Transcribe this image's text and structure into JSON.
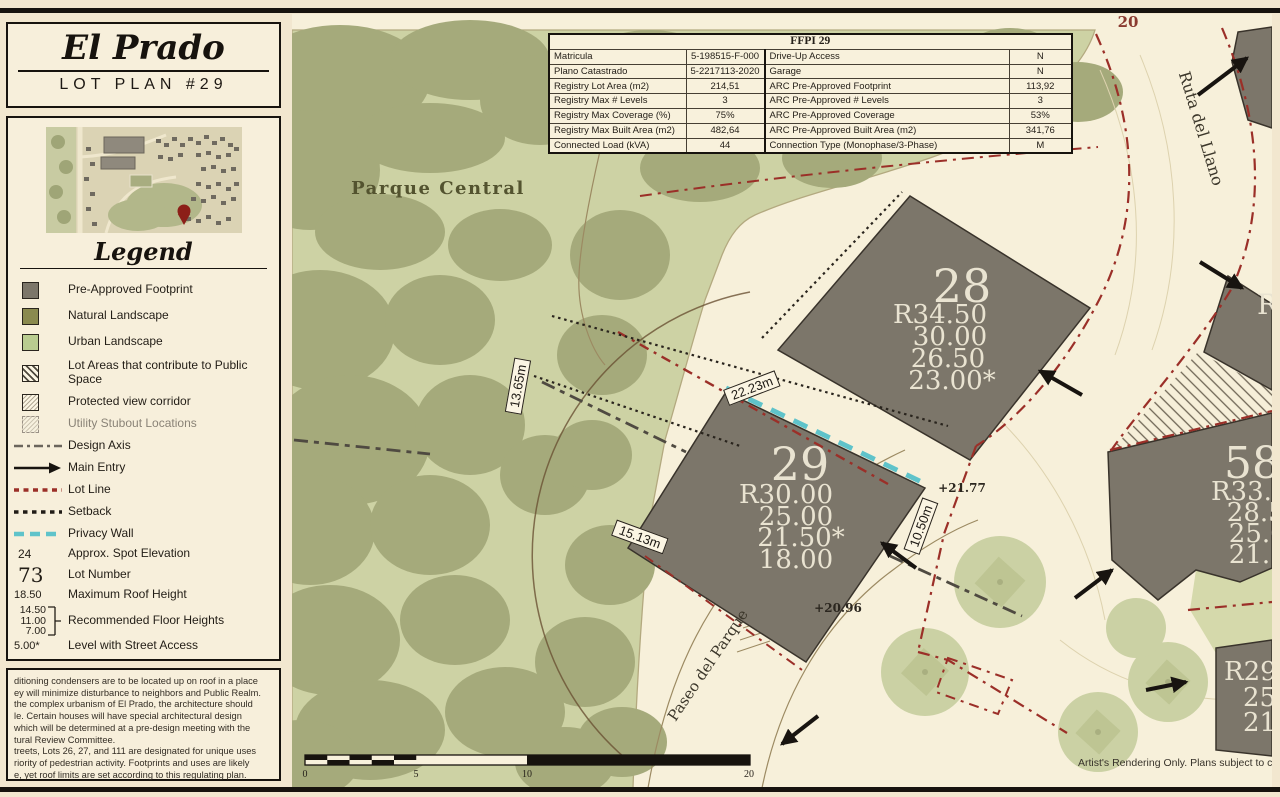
{
  "title": {
    "name": "El Prado",
    "subtitle": "LOT PLAN #29"
  },
  "legend": {
    "heading": "Legend",
    "items": [
      {
        "label": "Pre-Approved Footprint"
      },
      {
        "label": "Natural Landscape"
      },
      {
        "label": "Urban Landscape"
      },
      {
        "label": "Lot Areas that contribute to Public Space"
      },
      {
        "label": "Protected view corridor"
      },
      {
        "label": "Utility Stubout Locations"
      },
      {
        "label": "Design Axis"
      },
      {
        "label": "Main Entry"
      },
      {
        "label": "Lot Line"
      },
      {
        "label": "Setback"
      },
      {
        "label": "Privacy Wall"
      },
      {
        "label": "Approx. Spot Elevation",
        "symbol_text": "24"
      },
      {
        "label": "Lot Number",
        "symbol_text": "73"
      },
      {
        "label": "Maximum Roof Height",
        "symbol_text": "18.50"
      },
      {
        "label": "Recommended Floor Heights",
        "symbol_values": [
          "14.50",
          "11.00",
          "7.00"
        ]
      },
      {
        "label": "Level with Street Access",
        "symbol_text": "5.00*"
      }
    ]
  },
  "notes_lines": [
    "ditioning condensers are to be located up on roof in a place",
    "ey will minimize disturbance to neighbors and Public Realm.",
    "the complex urbanism of El Prado, the architecture should",
    "le. Certain houses will have special architectural design",
    "which will be determined at a pre-design meeting with the",
    "tural Review Committee.",
    "treets, Lots 26, 27, and 111 are designated for unique uses",
    "riority of pedestrian activity. Footprints and uses are likely",
    "e, yet roof limits are set according to this regulating plan."
  ],
  "table": {
    "header": "FFPI 29",
    "rows": [
      {
        "c0": "Matricula",
        "c1": "5-198515-F-000",
        "c2": "Drive-Up Access",
        "c3": "N"
      },
      {
        "c0": "Plano Catastrado",
        "c1": "5-2217113-2020",
        "c2": "Garage",
        "c3": "N"
      },
      {
        "c0": "Registry Lot Area (m2)",
        "c1": "214,51",
        "c2": "ARC Pre-Approved Footprint",
        "c3": "113,92"
      },
      {
        "c0": "Registry Max # Levels",
        "c1": "3",
        "c2": "ARC Pre-Approved # Levels",
        "c3": "3"
      },
      {
        "c0": "Registry Max Coverage (%)",
        "c1": "75%",
        "c2": "ARC Pre-Approved Coverage",
        "c3": "53%"
      },
      {
        "c0": "Registry Max Built Area (m2)",
        "c1": "482,64",
        "c2": "ARC Pre-Approved Built Area (m2)",
        "c3": "341,76"
      },
      {
        "c0": "Connected Load (kVA)",
        "c1": "44",
        "c2": "Connection Type (Monophase/3-Phase)",
        "c3": "M"
      }
    ]
  },
  "map": {
    "park_label": "Parque Central",
    "street_number": "20",
    "streets": {
      "ruta": "Ruta del Llano",
      "paseo": "Paseo del Parque"
    },
    "lots": {
      "lot28": {
        "number": "28",
        "heights": [
          "R34.50",
          "30.00",
          "26.50",
          "23.00*"
        ]
      },
      "lot29": {
        "number": "29",
        "heights": [
          "R30.00",
          "25.00",
          "21.50*",
          "18.00"
        ]
      },
      "lot58": {
        "number": "58",
        "heights": [
          "R33.50",
          "28.50",
          "25.00",
          "21.50"
        ]
      },
      "lot_br": {
        "heights": [
          "R29.50",
          "25.00",
          "21.50"
        ]
      },
      "lot_right_partial": "R"
    },
    "dimensions": {
      "d1": "22.23m",
      "d2": "13.65m",
      "d3": "15.13m",
      "d4": "10.50m"
    },
    "spot_elevations": {
      "s1": "+21.77",
      "s2": "+20.96"
    },
    "scale_labels": [
      "0",
      "5",
      "10",
      "20"
    ],
    "disclaimer": "Artist's Rendering Only. Plans subject to change. Octo"
  },
  "colors": {
    "footprint_gray": "#7c766a",
    "natural_olive": "#8a8a4f",
    "urban_green": "#b9cc90",
    "park_base": "#cdd2a4",
    "canopy": "#a5aa7b",
    "road_cream": "#f7f0da",
    "lot_line_red": "#9b2f28",
    "privacy_teal": "#5fc3ca",
    "page_cream": "#f2e7cf"
  }
}
